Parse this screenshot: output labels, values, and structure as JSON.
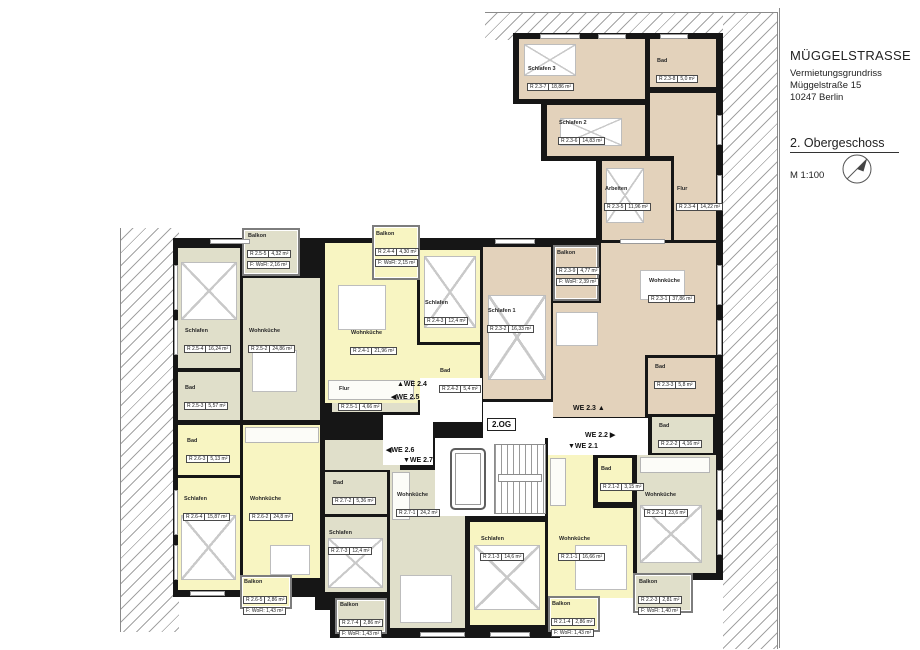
{
  "title_block": {
    "project": "MÜGGELSTRASSE",
    "subtitle": "Vermietungsgrundriss",
    "street": "Müggelstraße 15",
    "city": "10247 Berlin",
    "floor": "2. Obergeschoss",
    "scale": "M 1:100"
  },
  "core": {
    "floor_tag": "2.OG",
    "unit_tags": [
      {
        "id": "we24",
        "label": "▲WE 2.4"
      },
      {
        "id": "we25",
        "label": "◀WE 2.5"
      },
      {
        "id": "we26",
        "label": "◀WE 2.6"
      },
      {
        "id": "we27",
        "label": "▼WE 2.7"
      },
      {
        "id": "we23",
        "label": "WE 2.3 ▲"
      },
      {
        "id": "we22",
        "label": "WE 2.2 ▶"
      },
      {
        "id": "we21",
        "label": "▼WE 2.1"
      }
    ]
  },
  "colors": {
    "unit_we23": "#e3d2bb",
    "units_we24_we26_we21": "#f8f5c2",
    "units_we25_we27_we22": "#e0dfca",
    "walls": "#161616"
  },
  "rooms": [
    {
      "name": "Schlafen 3",
      "code": "R 2.3-7",
      "area": "18,86 m²"
    },
    {
      "name": "Bad",
      "code": "R 2.3-8",
      "area": "5,0 m²"
    },
    {
      "name": "Schlafen 2",
      "code": "R 2.3-6",
      "area": "14,83 m²"
    },
    {
      "name": "Arbeiten",
      "code": "R 2.3-5",
      "area": "11,96 m²"
    },
    {
      "name": "Flur",
      "code": "R 2.3-4",
      "area": "14,22 m²"
    },
    {
      "name": "Balkon",
      "code": "R 2.3-9",
      "area": "4,77 m²",
      "wofl": "F: WoFl: 2,39 m²"
    },
    {
      "name": "Schlafen 1",
      "code": "R 2.3-2",
      "area": "16,33 m²"
    },
    {
      "name": "Wohnküche",
      "code": "R 2.3-1",
      "area": "37,86 m²"
    },
    {
      "name": "Bad",
      "code": "R 2.3-3",
      "area": "5,8 m²"
    },
    {
      "name": "Balkon",
      "code": "R 2.5-5",
      "area": "4,32 m²",
      "wofl": "F: WoFl: 2,16 m²"
    },
    {
      "name": "Schlafen",
      "code": "R 2.5-4",
      "area": "16,24 m²"
    },
    {
      "name": "Wohnküche",
      "code": "R 2.5-2",
      "area": "24,86 m²"
    },
    {
      "name": "Bad",
      "code": "R 2.5-3",
      "area": "5,57 m²"
    },
    {
      "name": "Flur",
      "code": "R 2.5-1",
      "area": "4,66 m²"
    },
    {
      "name": "Balkon",
      "code": "R 2.4-4",
      "area": "4,30 m²",
      "wofl": "F: WoFl: 2,15 m²"
    },
    {
      "name": "Wohnküche",
      "code": "R 2.4-1",
      "area": "21,96 m²"
    },
    {
      "name": "Schlafen",
      "code": "R 2.4-3",
      "area": "12,4 m²"
    },
    {
      "name": "Bad",
      "code": "R 2.4-2",
      "area": "5,4 m²"
    },
    {
      "name": "Bad",
      "code": "R 2.6-3",
      "area": "5,13 m²"
    },
    {
      "name": "Schlafen",
      "code": "R 2.6-4",
      "area": "15,87 m²"
    },
    {
      "name": "Wohnküche",
      "code": "R 2.6-2",
      "area": "24,8 m²"
    },
    {
      "name": "Balkon",
      "code": "R 2.6-5",
      "area": "2,86 m²",
      "wofl": "F: WoFl: 1,43 m²"
    },
    {
      "name": "Bad",
      "code": "R 2.7-2",
      "area": "5,36 m²"
    },
    {
      "name": "Schlafen",
      "code": "R 2.7-3",
      "area": "12,4 m²"
    },
    {
      "name": "Wohnküche",
      "code": "R 2.7-1",
      "area": "24,2 m²"
    },
    {
      "name": "Balkon",
      "code": "R 2.7-4",
      "area": "2,86 m²",
      "wofl": "F: WoFl: 1,43 m²"
    },
    {
      "name": "Bad",
      "code": "R 2.1-2",
      "area": "3,15 m²"
    },
    {
      "name": "Schlafen",
      "code": "R 2.1-3",
      "area": "14,6 m²"
    },
    {
      "name": "Wohnküche",
      "code": "R 2.1-1",
      "area": "16,66 m²"
    },
    {
      "name": "Balkon",
      "code": "R 2.1-4",
      "area": "2,86 m²",
      "wofl": "F: WoFl: 1,43 m²"
    },
    {
      "name": "Bad",
      "code": "R 2.2-2",
      "area": "4,16 m²"
    },
    {
      "name": "Wohnküche",
      "code": "R 2.2-1",
      "area": "23,6 m²"
    },
    {
      "name": "Balkon",
      "code": "R 2.2-3",
      "area": "2,81 m²",
      "wofl": "F: WoFl: 1,40 m²"
    }
  ]
}
